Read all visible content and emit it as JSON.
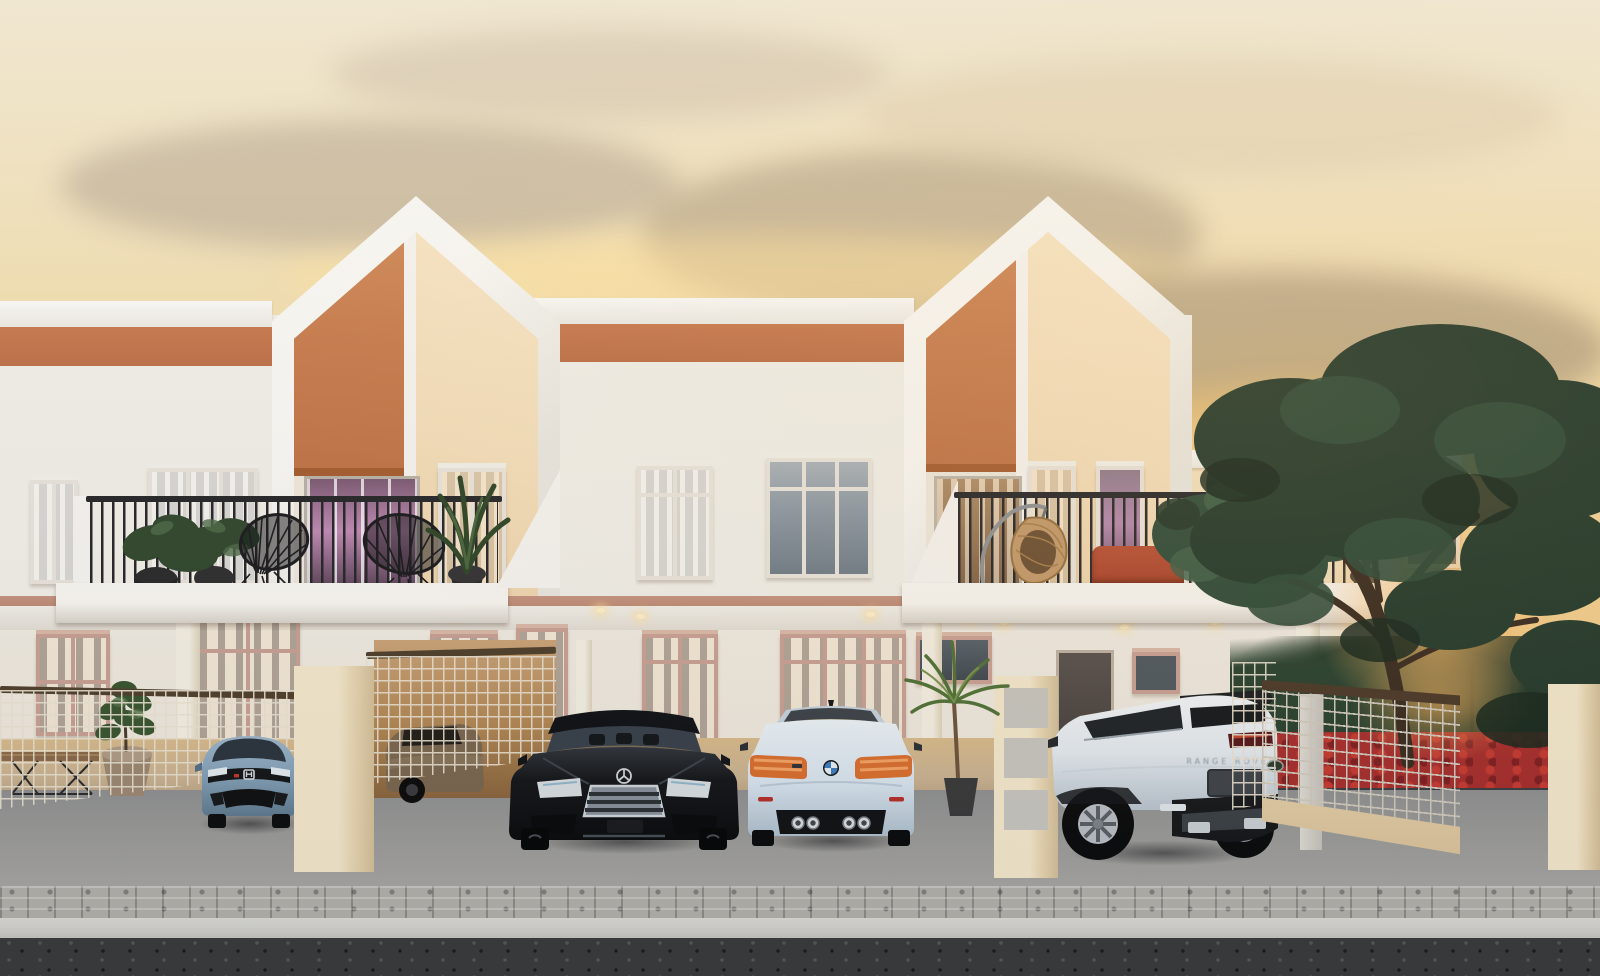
{
  "meta": {
    "title": "Terraced Houses at Sunset — Architectural Rendering",
    "description": "Photorealistic 3D exterior rendering of a row of modern two-storey terraced houses at sunset: white facades with gabled terracotta and cream accent panels, first-floor balconies with black metal railings, recessed porches with downlights, wire-mesh fences and gates, a paved driveway with parked cars, and a large backlit tree on the right."
  },
  "palette": {
    "sky-top": "#efe7d2",
    "sky-mid": "#f2ddab",
    "sky-gold": "#f3d193",
    "sky-low": "#efc57e",
    "wall-white": "#f1efe9",
    "band-orange": "#c87950",
    "gable-orange": "#c97e50",
    "gable-cream": "#f4debb",
    "win-frame": "#e9e4dc",
    "win-frame-pink": "#c9a095",
    "fascia-pink": "#bd8b76",
    "railing": "#26262a",
    "cream-pillar": "#e7d5b2",
    "mesh-light": "#e9e1d2",
    "mesh-rail": "#50402e",
    "gate-mesh": "#cfc9bd",
    "gate-rail": "#4a3829",
    "sofa-red": "#a8432c",
    "floor-warm": "#c9b393",
    "drive-gray": "#9b9b99",
    "paver": "#b3b1ac",
    "curb": "#d0cfcb",
    "asphalt": "#3a3c3e",
    "hedge-red": "#a62e2e",
    "tree-green": "#2d4436",
    "tree-glow": "#ef9a48",
    "honda-blue": "#84a0b8",
    "merc-black": "#1a1d21",
    "bmw-ice": "#d7e3ee",
    "evoque-white": "#e8edf2",
    "bronze": "#7b6750"
  },
  "scene": {
    "time_of_day": "sunset",
    "units_visible": 4,
    "facade_colors": [
      "white",
      "terracotta",
      "cream"
    ],
    "balcony_left_items": [
      "potted plants",
      "two black wire acapulco chairs",
      "glass door with purple interior light"
    ],
    "balcony_right_items": [
      "rattan hanging egg chair",
      "red loveseats",
      "potted plants"
    ],
    "cars": [
      {
        "type": "hatchback",
        "color": "steel blue",
        "view": "front",
        "brand_icon": "honda-logo"
      },
      {
        "type": "sedan",
        "color": "bronze",
        "view": "behind mesh fence"
      },
      {
        "type": "luxury sedan",
        "color": "black",
        "view": "front",
        "brand_icon": "mercedes-star"
      },
      {
        "type": "sports coupe",
        "color": "ice blue",
        "view": "rear",
        "brand_icon": "bmw-roundel"
      },
      {
        "type": "compact SUV",
        "color": "white silver",
        "view": "rear three-quarter",
        "brand_icon": "land-rover-badge"
      }
    ],
    "evoque_badge": "RANGE ROVER",
    "vegetation": [
      "large backlit tree",
      "small tree",
      "balcony plants",
      "fiddle-leaf plant in clay pot",
      "palm plant",
      "red flowering hedge"
    ],
    "street_furniture": [
      "wooden bench with wire legs"
    ]
  }
}
